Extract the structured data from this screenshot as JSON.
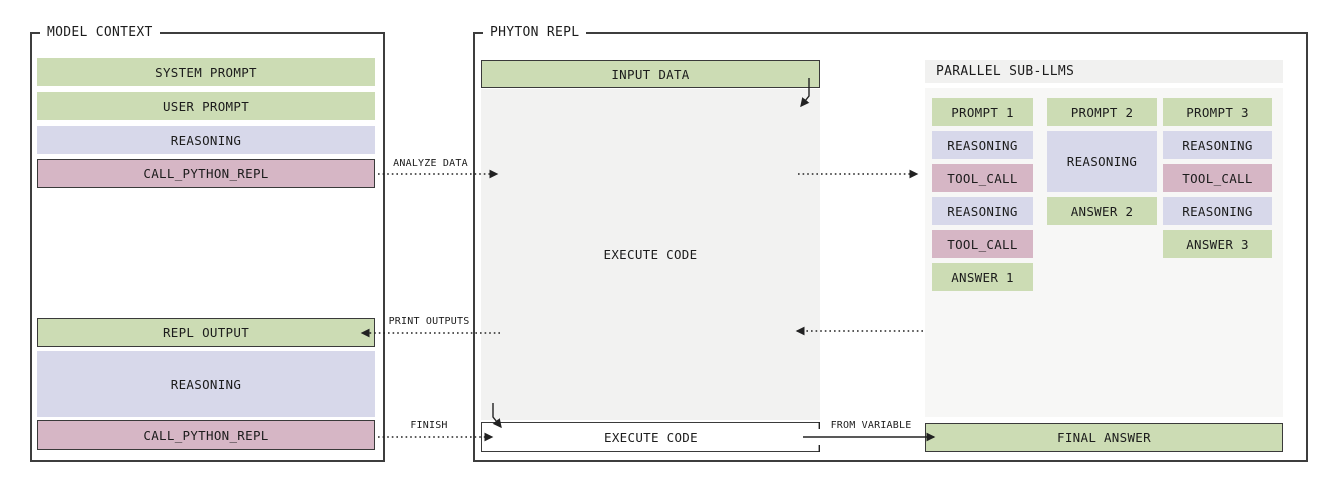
{
  "model_context": {
    "title": "MODEL CONTEXT",
    "blocks": [
      {
        "label": "SYSTEM PROMPT",
        "kind": "prompt"
      },
      {
        "label": "USER PROMPT",
        "kind": "prompt"
      },
      {
        "label": "REASONING",
        "kind": "reasoning"
      },
      {
        "label": "CALL_PYTHON_REPL",
        "kind": "tool-call"
      },
      {
        "label": "REPL OUTPUT",
        "kind": "repl-output"
      },
      {
        "label": "REASONING",
        "kind": "reasoning"
      },
      {
        "label": "CALL_PYTHON_REPL",
        "kind": "tool-call"
      }
    ]
  },
  "python_repl": {
    "title": "PHYTON REPL",
    "input_data": {
      "label": "INPUT DATA"
    },
    "execute_area": {
      "label": "EXECUTE CODE"
    },
    "execute_box": {
      "label": "EXECUTE CODE"
    },
    "final_answer": {
      "label": "FINAL ANSWER"
    }
  },
  "sub_llms": {
    "title": "PARALLEL SUB-LLMS",
    "columns": [
      {
        "blocks": [
          {
            "label": "PROMPT 1",
            "kind": "prompt"
          },
          {
            "label": "REASONING",
            "kind": "reasoning"
          },
          {
            "label": "TOOL_CALL",
            "kind": "tool-call"
          },
          {
            "label": "REASONING",
            "kind": "reasoning"
          },
          {
            "label": "TOOL_CALL",
            "kind": "tool-call"
          },
          {
            "label": "ANSWER 1",
            "kind": "answer"
          }
        ]
      },
      {
        "blocks": [
          {
            "label": "PROMPT 2",
            "kind": "prompt"
          },
          {
            "label": "REASONING",
            "kind": "reasoning"
          },
          {
            "label": "ANSWER 2",
            "kind": "answer"
          }
        ]
      },
      {
        "blocks": [
          {
            "label": "PROMPT 3",
            "kind": "prompt"
          },
          {
            "label": "REASONING",
            "kind": "reasoning"
          },
          {
            "label": "TOOL_CALL",
            "kind": "tool-call"
          },
          {
            "label": "REASONING",
            "kind": "reasoning"
          },
          {
            "label": "ANSWER 3",
            "kind": "answer"
          }
        ]
      }
    ]
  },
  "arrows": {
    "analyze_data": {
      "label": "ANALYZE DATA"
    },
    "print_outputs": {
      "label": "PRINT OUTPUTS"
    },
    "finish": {
      "label": "FINISH"
    },
    "from_variable": {
      "label": "FROM VARIABLE"
    }
  },
  "colors": {
    "prompt_green": "#ccdcb4",
    "reasoning_lavender": "#d7d8ea",
    "tool_call_pink": "#d6b6c5",
    "border_dark": "#3a3a3a",
    "repl_gray": "#f2f2f1",
    "panel_gray": "#f7f7f6",
    "panel_header_gray": "#f1f1f0"
  }
}
